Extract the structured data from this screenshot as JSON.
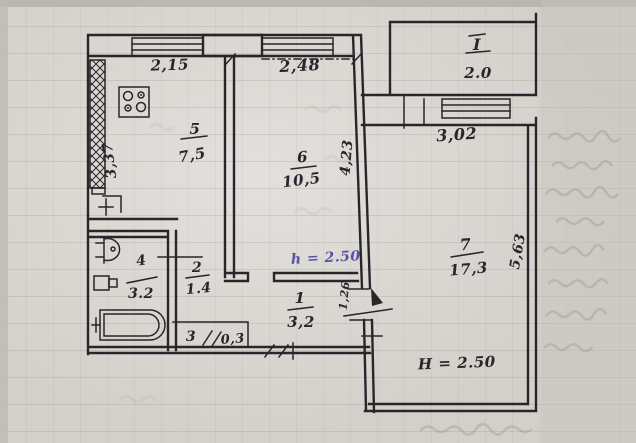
{
  "colors": {
    "ink": "#28252b",
    "accent_note": "#5b50a8",
    "paper": "#d3d0ca",
    "ghost": "#968f84"
  },
  "rooms": {
    "r1": {
      "number": "1",
      "area": "3,2"
    },
    "r2": {
      "number": "2",
      "area": "1.4"
    },
    "r3": {
      "number": "3",
      "area": "0,3"
    },
    "r4": {
      "number": "4",
      "area": "3.2"
    },
    "r5": {
      "number": "5",
      "area": "7,5"
    },
    "r6": {
      "number": "6",
      "area": "10,5"
    },
    "r7": {
      "number": "7",
      "area": "17,3"
    },
    "balcony": {
      "number": "I",
      "area": "2.0"
    }
  },
  "dimensions": {
    "kitchen_width": "2,15",
    "room6_width": "2,48",
    "room7_width": "3,02",
    "kitchen_depth": "3,37",
    "room6_depth": "4,23",
    "room7_depth": "5,63",
    "hall_passage": "1,26"
  },
  "notes": {
    "room6_height": "h = 2.50",
    "room7_height": "H = 2.50"
  },
  "fixtures": [
    "stove-icon",
    "sink-icon",
    "toilet-icon",
    "bathtub-icon"
  ]
}
